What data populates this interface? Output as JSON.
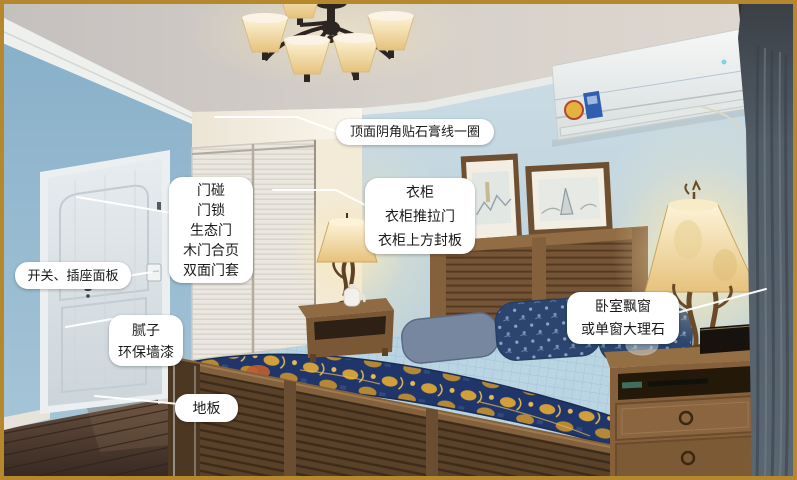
{
  "annotations": {
    "ceiling_molding": {
      "lines": [
        "顶面阴角贴石膏线一圈"
      ]
    },
    "door": {
      "lines": [
        "门碰",
        "门锁",
        "生态门",
        "木门合页",
        "双面门套"
      ]
    },
    "switch_socket": {
      "lines": [
        "开关、插座面板"
      ]
    },
    "wall_paint": {
      "lines": [
        "腻子",
        "环保墙漆"
      ]
    },
    "floor": {
      "lines": [
        "地板"
      ]
    },
    "wardrobe": {
      "lines": [
        "衣柜",
        "衣柜推拉门",
        "衣柜上方封板"
      ]
    },
    "bay_window": {
      "lines": [
        "卧室飘窗",
        "或单窗大理石"
      ]
    }
  },
  "colors": {
    "frame-gold": "#b6882e",
    "label-bg": "#ffffff",
    "label-text": "#1a1a1a",
    "leader-line": "#ffffff",
    "wall-blue": "#9dbfd3",
    "wall-back": "#c6d8e1",
    "wood-brown": "#7b5a39",
    "bedspread-blue": "#b9d4e2",
    "quilt-navy": "#233a6c",
    "quilt-gold": "#d4a23c",
    "curtain-gray": "#57626d",
    "floor-brown": "#4a372c",
    "lamp-glow": "#f6e3b0"
  }
}
